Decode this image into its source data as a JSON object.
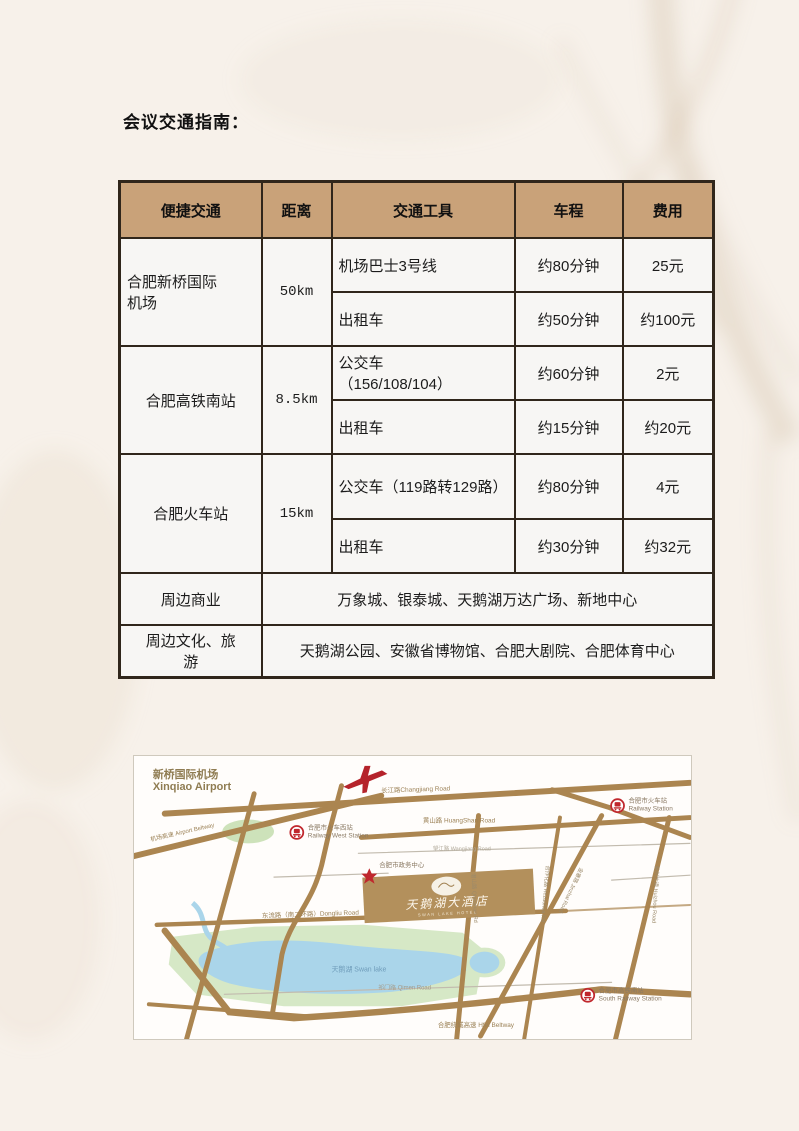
{
  "page": {
    "title": "会议交通指南："
  },
  "table": {
    "headers": [
      "便捷交通",
      "距离",
      "交通工具",
      "车程",
      "费用"
    ],
    "groups": [
      {
        "location": "合肥新桥国际\n机场",
        "distance": "50km",
        "options": [
          {
            "vehicle": "机场巴士3号线",
            "duration": "约80分钟",
            "cost": "25元"
          },
          {
            "vehicle": "出租车",
            "duration": "约50分钟",
            "cost": "约100元"
          }
        ]
      },
      {
        "location": "合肥高铁南站",
        "distance": "8.5km",
        "options": [
          {
            "vehicle": "公交车\n（156/108/104）",
            "duration": "约60分钟",
            "cost": "2元"
          },
          {
            "vehicle": "出租车",
            "duration": "约15分钟",
            "cost": "约20元"
          }
        ]
      },
      {
        "location": "合肥火车站",
        "distance": "15km",
        "options": [
          {
            "vehicle": "公交车（119路转129路）",
            "duration": "约80分钟",
            "cost": "4元"
          },
          {
            "vehicle": "出租车",
            "duration": "约30分钟",
            "cost": "约32元"
          }
        ]
      }
    ],
    "extra_rows": [
      {
        "label": "周边商业",
        "value": "万象城、银泰城、天鹅湖万达广场、新地中心"
      },
      {
        "label": "周边文化、旅\n游",
        "value": "天鹅湖公园、安徽省博物馆、合肥大剧院、合肥体育中心"
      }
    ]
  },
  "map": {
    "labels": {
      "airport_cn": "新桥国际机场",
      "airport_en": "Xinqiao Airport",
      "airport_beltway": "机场高速 Airport Beltway",
      "changjiang_road": "长江路Changjiang Road",
      "huangshan_road": "黄山路 HuangShan Road",
      "wangjiang_road": "望江路 Wangjiang Road",
      "west_station_cn": "合肥市火车西站",
      "west_station_en": "Railway West Station",
      "gov_center": "合肥市政务中心",
      "railway_station_cn": "合肥市火车站",
      "railway_station_en": "Railway Station",
      "dongliu_road": "东流路（南二环路）Dongliu Road",
      "swan_lake": "天鹅湖 Swan lake",
      "qimen_road": "祁门路 Qimen Road",
      "hfei_beltway": "合肥绕城高速 Hfei Beltway",
      "south_station_cn": "合肥市高铁南站",
      "south_station_en": "South Railway Station",
      "qianshan_road": "潜山路 Qianshan Rd",
      "hezuohua_road": "合作化路 Hezuohua Rd",
      "jinzhai_road": "金寨路 Jinzhai Road",
      "huizhou_road": "徽州大道 Huizhou Road",
      "hotel_name": "天鹅湖大酒店",
      "hotel_sub": "SWAN LAKE HOTEL"
    },
    "colors": {
      "road_brown": "#ab8550",
      "water_blue": "#aad5ea",
      "park_green": "#d6e8c6",
      "hotel_tan": "#b3905c",
      "accent_red": "#c0272d",
      "header_tan": "#c9a279"
    }
  }
}
